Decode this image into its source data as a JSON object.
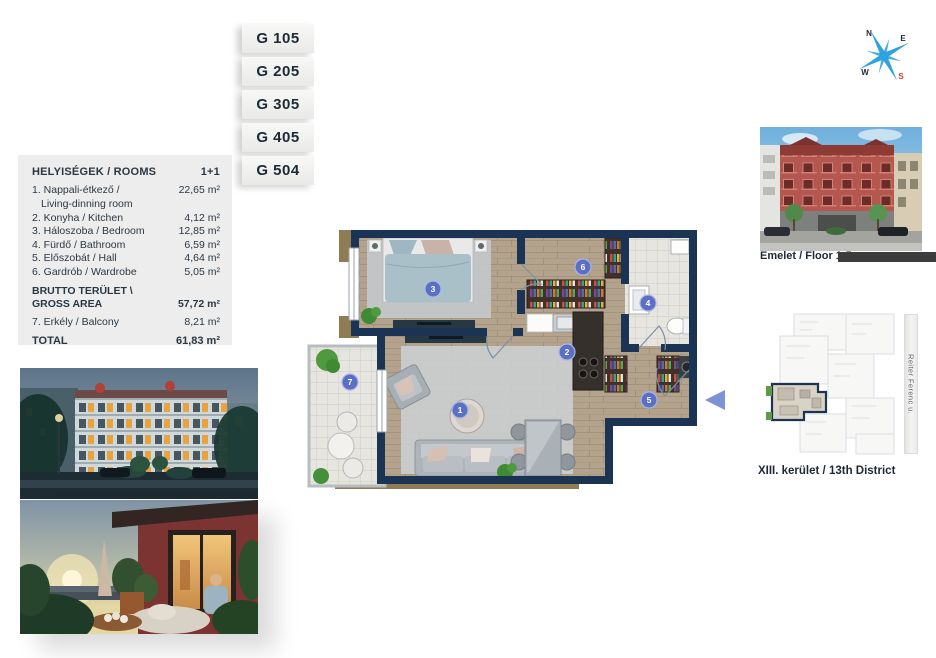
{
  "colors": {
    "wall_navy": "#1b3453",
    "badge_blue": "#5b70c5",
    "entrance_arrow_blue": "#7e92d8",
    "compass_blue": "#2fa3dc",
    "compass_south_red": "#d03a2e",
    "panel_gray": "#ecedec",
    "caption_bar_dark": "#3d3d3d",
    "elevation_building_red": "#b5574e"
  },
  "unit_tabs": [
    {
      "label": "G 105"
    },
    {
      "label": "G 205"
    },
    {
      "label": "G 305"
    },
    {
      "label": "G 405"
    },
    {
      "label": "G 504"
    }
  ],
  "rooms_panel": {
    "title": "HELYISÉGEK / ROOMS",
    "unit_type": "1+1",
    "rows": [
      {
        "label": "1. Nappali-étkező /",
        "label_line2": "Living-dinning room",
        "value": "22,65 m²"
      },
      {
        "label": "2. Konyha / Kitchen",
        "value": "4,12 m²"
      },
      {
        "label": "3. Háloszoba / Bedroom",
        "value": "12,85 m²"
      },
      {
        "label": "4. Fürdő / Bathroom",
        "value": "6,59 m²"
      },
      {
        "label": "5. Előszobát / Hall",
        "value": "4,64 m²"
      },
      {
        "label": "6. Gardrób / Wardrobe",
        "value": "5,05 m²"
      }
    ],
    "gross": {
      "label_line1": "BRUTTO TERÜLET \\",
      "label_line2": "GROSS AREA",
      "value": "57,72 m²"
    },
    "balcony_row": {
      "label": "7. Erkély / Balcony",
      "value": "8,21 m²"
    },
    "total": {
      "label": "TOTAL",
      "value": "61,83 m²"
    }
  },
  "floor_plan": {
    "badges": [
      "1",
      "2",
      "3",
      "4",
      "5",
      "6",
      "7"
    ]
  },
  "compass": {
    "north": "N",
    "east": "E",
    "west": "W",
    "south": "S"
  },
  "elevation": {
    "caption": "Emelet / Floor 1-5"
  },
  "site_plan": {
    "caption": "XIII. kerület / 13th District",
    "street_label": "Reiter Ferenc u."
  }
}
